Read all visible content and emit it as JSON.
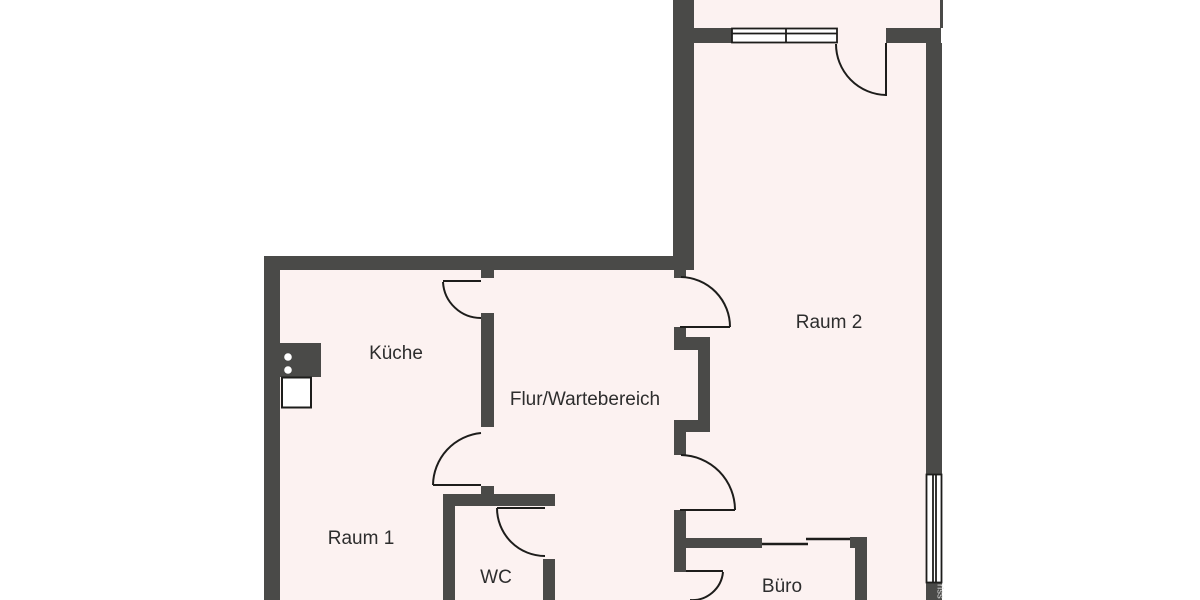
{
  "colors": {
    "background": "#ffffff",
    "wall": "#4a4a48",
    "line": "#1d1d1b",
    "floor": "#fcf2f1",
    "label": "#2d2d2d",
    "watermark": "#d9d9d9"
  },
  "rooms": {
    "kueche": {
      "label": "Küche"
    },
    "flur": {
      "label": "Flur/Wartebereich"
    },
    "raum2": {
      "label": "Raum 2"
    },
    "raum1": {
      "label": "Raum 1"
    },
    "wc": {
      "label": "WC"
    },
    "buero": {
      "label": "Büro"
    }
  },
  "watermark": {
    "text": "riss"
  }
}
